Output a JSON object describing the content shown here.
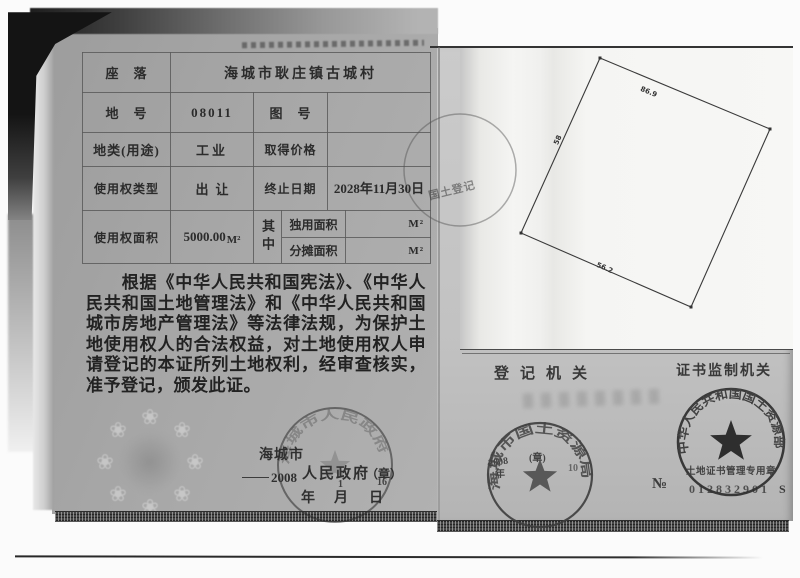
{
  "certificate": {
    "location_label": "座　落",
    "location_value": "海城市耿庄镇古城村",
    "parcel_no_label": "地　号",
    "parcel_no_value": "08011",
    "map_no_label": "图　号",
    "land_class_label": "地类(用途)",
    "land_class_value": "工业",
    "price_label": "取得价格",
    "right_type_label": "使用权类型",
    "right_type_value": "出让",
    "end_date_label": "终止日期",
    "end_date_value": "2028年11月30日",
    "area_label": "使用权面积",
    "area_value": "5000.00",
    "area_unit": "M²",
    "among_label": "其中",
    "sole_area_label": "独用面积",
    "sole_area_unit": "M²",
    "shared_area_label": "分摊面积",
    "shared_area_unit": "M²"
  },
  "legal_text": "根据《中华人民共和国宪法》、《中华人民共和国土地管理法》和《中华人民共和国城市房地产管理法》等法律法规，为保护土地使用权人的合法权益，对土地使用权人申请登记的本证所列土地权利，经审查核实，准予登记，颁发此证。",
  "issuer": {
    "city": "海城市",
    "government": "人民政府",
    "seal_note": "（章）",
    "year_value": "2008",
    "month_value": "1",
    "day_value": "16",
    "year_label": "年",
    "month_label": "月",
    "day_label": "日",
    "gov_seal_arc": "海城市人民政府"
  },
  "registry": {
    "section_label": "登记机关",
    "seal_arc": "海城市国土资源局",
    "seal_year": "2008",
    "seal_year_label": "年",
    "seal_note": "(章)",
    "seal_day": "10"
  },
  "supervision": {
    "section_label": "证书监制机关",
    "seal_arc": "中华人民共和国国土资源部",
    "seal_inner": "土地证书管理专用章",
    "serial_prefix": "№",
    "serial_number": "012832901",
    "serial_suffix": "S"
  },
  "plot": {
    "edge_top": "86.9",
    "edge_left": "58",
    "edge_bottom": "56.2",
    "faint_seal_text": "国土登记"
  },
  "watermark": {
    "glyph": "❀"
  }
}
